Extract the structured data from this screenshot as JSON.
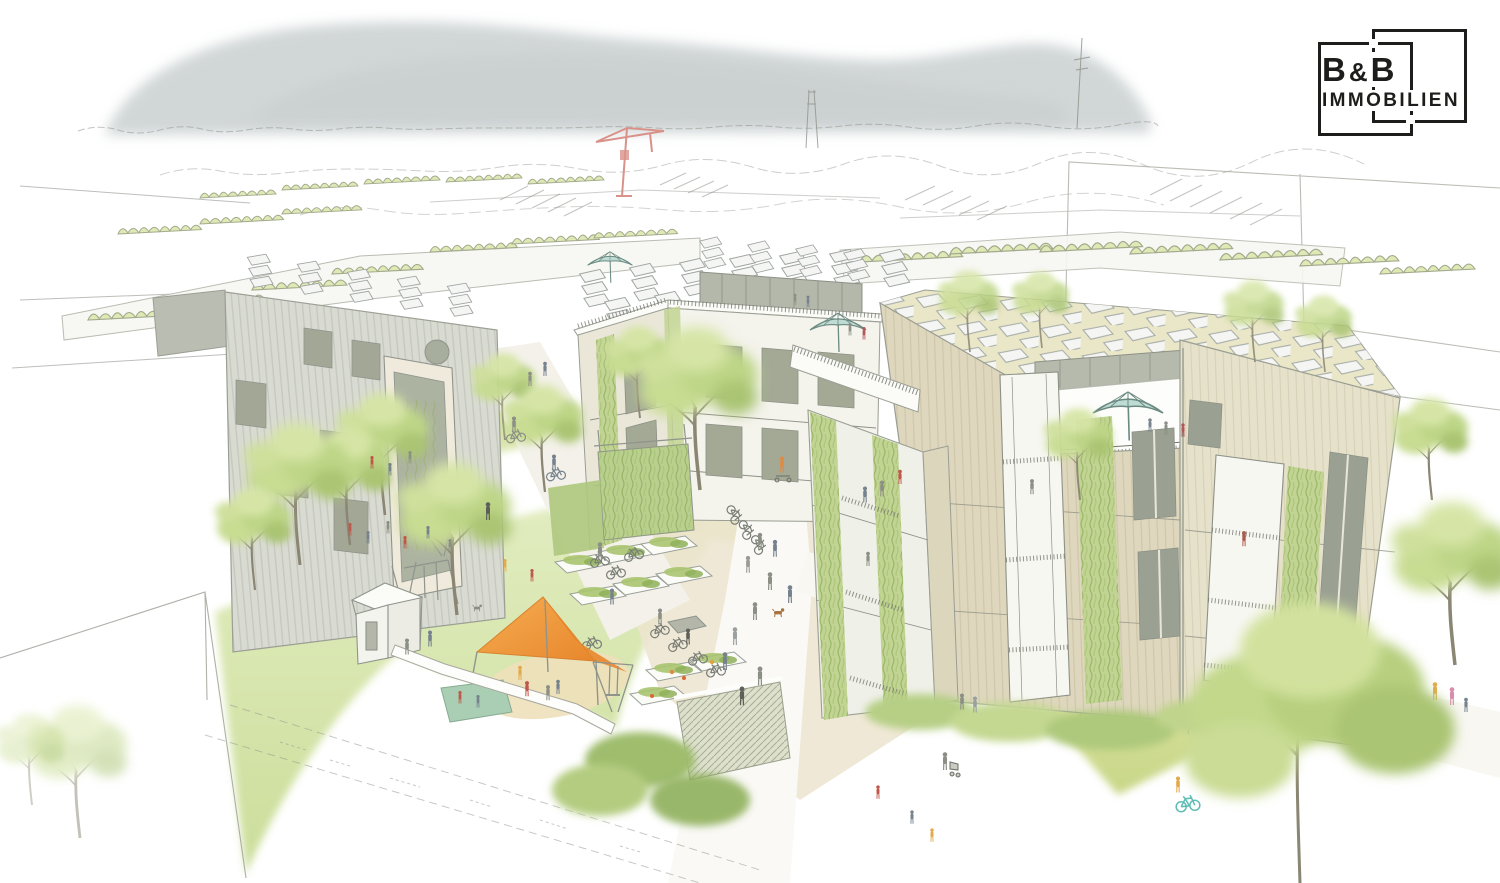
{
  "page": {
    "title": "B&B Immobilien – Wohnquartier Visualisierung"
  },
  "logo": {
    "line1_left": "B",
    "line1_amp": "&",
    "line1_right": "B",
    "line2": "IMMOBILIEN",
    "ink": "#1d1d1b"
  },
  "scene": {
    "description": "Hand-drawn watercolor architectural visualization of a car-free residential quarter: three timber apartment buildings with rooftop solar panels, roof terraces with teal umbrellas and green facades around a shared courtyard with community garden beds, bicycle parking, a playground with an orange shade sail, lawns, meadows and street trees; hazy mountain and city skyline with a construction crane in the background; B&B Immobilien logo top right.",
    "elements": [
      "mountain-backdrop",
      "city-skyline-sketch",
      "construction-crane",
      "flag-pole",
      "midground-flat-roofs-with-bushes",
      "left-apartment-building",
      "middle-apartment-building",
      "right-apartment-building",
      "rooftop-solar-panels",
      "rooftop-terraces-with-teal-umbrellas",
      "green-climbing-facades",
      "background-building-outline",
      "community-garden-raised-beds",
      "bicycle-racks",
      "pedestrian-paths-with-residents",
      "playground-with-orange-shade-sail",
      "garden-pavilion",
      "picnic-blanket",
      "sandpit",
      "wildflower-meadow",
      "teal-bicycle",
      "street-trees",
      "dog-walkers",
      "stroller",
      "scooter-riders"
    ]
  },
  "palette": {
    "logo_ink": "#1d1d1b",
    "mountain": "#b5bec0",
    "sketch_line": "#8f948c",
    "foliage_light": "#dce8b0",
    "foliage": "#c3d88b",
    "foliage_dark": "#9dba67",
    "lawn": "#d9e6ad",
    "facade_gray": "#d9dbd2",
    "facade_cream": "#edebdf",
    "facade_tan": "#ddd6bd",
    "window_sage": "#a2a896",
    "solar_panel": "#f5f6f4",
    "gravel": "#e9e1cb",
    "sail_orange": "#ef9c3f",
    "umbrella_teal": "#bedcd4",
    "crane_red": "#d9928a",
    "blanket_green": "#a9ceb4",
    "bike_teal": "#5fbdb5",
    "person_red": "#c0574a",
    "person_yellow": "#e3a94c",
    "person_blue": "#76828e"
  }
}
